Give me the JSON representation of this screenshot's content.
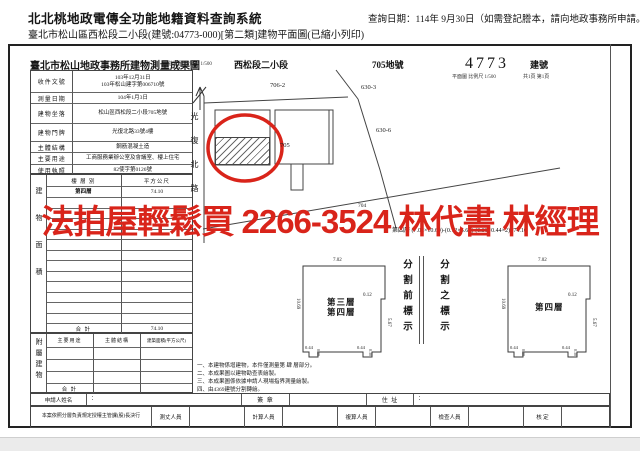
{
  "header": {
    "system_title": "北北桃地政電傳全功能地籍資料查詢系統",
    "query_date": "查詢日期：114年 9月30日（如需登記謄本，請向地政事務所申請。）",
    "subtitle": "臺北市松山區西松段二小段(建號:04773-000)[第二類]建物平面圖(已縮小列印)"
  },
  "doc": {
    "office_title": "臺北市松山地政事務所建物測量成果圖",
    "section": "西松段二小段",
    "land_no": "705地號",
    "building_no": "4773",
    "building_no_label": "建號",
    "scale_location": "位置圖 比例尺 1/500",
    "scale_plan": "平面圖 比例尺 1/500",
    "page_info": "共1頁 第1頁"
  },
  "info_table": {
    "rows": [
      {
        "label": "收件文號",
        "value": "103年12月31日",
        "value2": "103年松山建字第006710號"
      },
      {
        "label": "測量日期",
        "value": "104年1月3日"
      },
      {
        "label": "建物坐落",
        "value": "松山區西松段二小段705地號"
      },
      {
        "label": "建物門牌",
        "value": "光復北路33號4樓"
      },
      {
        "label": "主體結構",
        "value": "鋼筋混凝土造"
      },
      {
        "label": "主要用途",
        "value": "工商服務業辦公室及會議室、樓上住宅"
      },
      {
        "label": "使用執照",
        "value": "82使字第0126號"
      }
    ]
  },
  "area_table": {
    "side_label": "建物面積",
    "col_floor": "樓 層 別",
    "col_area": "平方公尺",
    "floor": "第四層",
    "area": "74.10",
    "total_label": "合 計",
    "total": "74.10"
  },
  "annex_table": {
    "side_label": "附屬建物",
    "col_use": "主要用途",
    "col_structure": "主體結構",
    "col_area": "建築面積(平方公尺)",
    "total_label": "合 計"
  },
  "applicant_row": {
    "name_label": "申請人姓名",
    "name_value": "：",
    "sign_label": "簽 章",
    "address_label": "住 址",
    "address_value": "："
  },
  "approval_row": {
    "note": "本案依照分層負責規定授權主管課(股)長決行",
    "roles": [
      "測丈人員",
      "計算人員",
      "複算人員",
      "檢查人員",
      "核 定"
    ]
  },
  "site_plan": {
    "street": "光復北路",
    "parcel_706_2": "706-2",
    "parcel_630_3": "630-3",
    "parcel_630_6": "630-6",
    "parcel_705": "705",
    "parcel_704": "704"
  },
  "plans": {
    "dims": {
      "top": "7.02",
      "left": "10.69",
      "step": "0.12",
      "right": "5.67",
      "notch": "0.44",
      "notch_depth": "0.30"
    },
    "left_label_1": "第三層",
    "left_label_2": "第四層",
    "right_label": "第四層",
    "divider_before": "分割前標示",
    "divider_after": "分割之標示",
    "calc": "第四層 (7.02×10.69)-(0.12×5.67)-(0.30×0.44×2)=74.10"
  },
  "notes": {
    "line1": "一、本建物係增建物，本件僅測量第 肆 層部分。",
    "line2": "二、本成果圖以建物勘查表繪製。",
    "line3": "三、本成果圖係依據申請人現場指界測量繪製。",
    "line4": "四、由4369建號分割轉繪。"
  },
  "watermark": {
    "text": "法拍屋輕鬆買 2266-3524 林代書 林經理",
    "color": "#d9241a"
  }
}
